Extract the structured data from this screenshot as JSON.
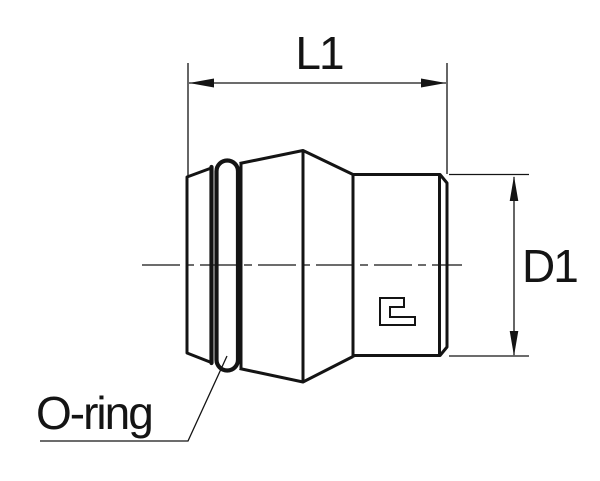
{
  "drawing": {
    "labels": {
      "length_dimension": "L1",
      "diameter_dimension": "D1",
      "oring_callout": "O-ring"
    },
    "icons": {
      "brand_mark": "c-shape-brand-glyph"
    },
    "colors": {
      "line": "#141414",
      "background": "#ffffff"
    }
  }
}
